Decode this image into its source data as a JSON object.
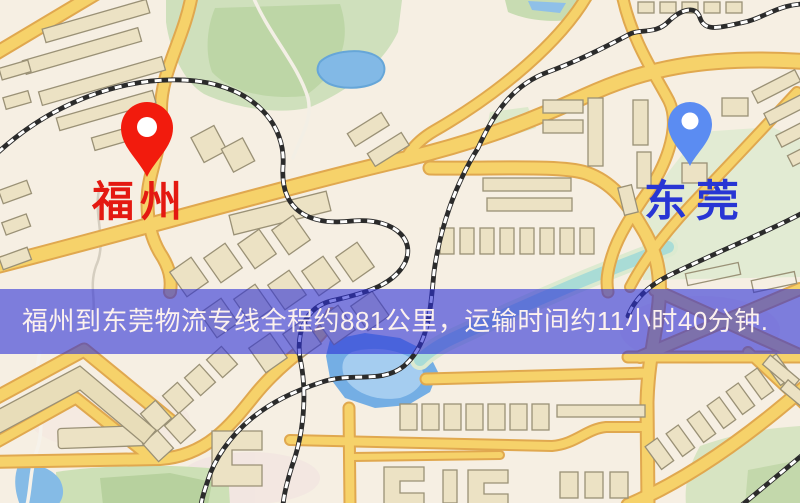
{
  "banner": {
    "text": "福州到东莞物流专线全程约881公里，运输时间约11小时40分钟.",
    "background": "rgba(45,48,215,0.6)",
    "text_color": "#fcf1ee"
  },
  "map": {
    "origin_marker": {
      "label": "福州",
      "label_color": "#e41911",
      "pin_color": "#f21b0d"
    },
    "destination_marker": {
      "label": "东莞",
      "label_color": "#2836d4",
      "pin_color": "#5b8cf2"
    },
    "palette": {
      "background": "#f6efe3",
      "road_fill": "#f6d26a",
      "road_casing": "#e0a84f",
      "park": "#cfe0bc",
      "water": "#74aee4",
      "building_fill": "#ece2c4",
      "building_stroke": "#9a9176",
      "railway": "#2b2b2b"
    }
  }
}
